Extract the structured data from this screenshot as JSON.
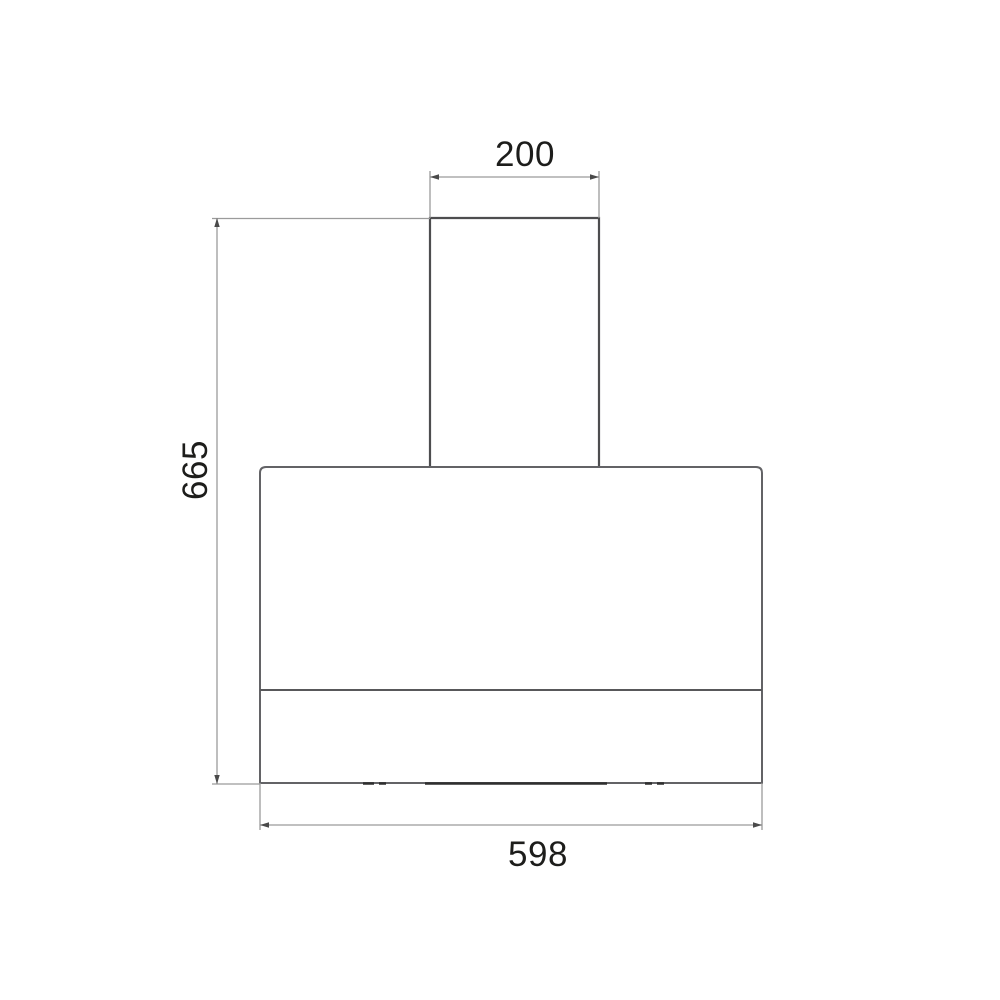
{
  "diagram": {
    "labels": {
      "top_width": "200",
      "side_height": "665",
      "bottom_width": "598"
    },
    "colors": {
      "background": "#ffffff",
      "chimney_line": "#4d4d4f",
      "body_line": "#636366",
      "divider_line": "#58585a",
      "detail_line": "#2e2e2e",
      "dimension_line": "#9b9b9b",
      "arrow": "#4a4a4a",
      "text": "#1d1d1b"
    }
  }
}
